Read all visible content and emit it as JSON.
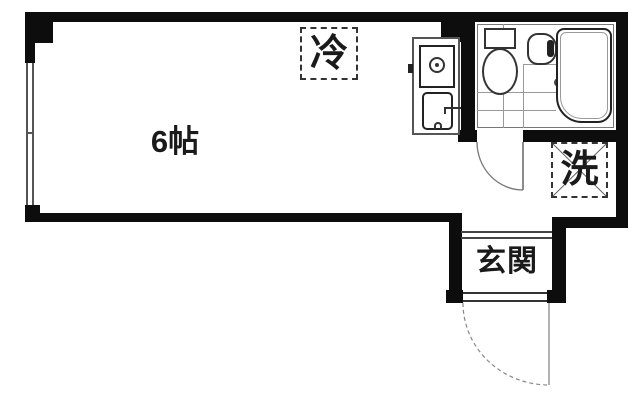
{
  "plan": {
    "title": "apartment-floor-plan",
    "room": {
      "label": "6帖"
    },
    "fridge_space": {
      "label": "冷"
    },
    "washer_space": {
      "label": "洗"
    },
    "entrance": {
      "label": "玄関"
    }
  },
  "fixtures": [
    "window",
    "kitchen-unit",
    "gas-stove-burner",
    "kitchen-sink",
    "unit-bathroom",
    "toilet",
    "wash-basin",
    "bathtub",
    "floor-drain",
    "bathroom-door",
    "entrance-door",
    "entrance-step",
    "entrance-threshold"
  ],
  "colors": {
    "wall": "#0d0d0d",
    "fixture_line": "#333333",
    "tile_line": "#9a9a9a",
    "door_line": "#777777",
    "text": "#1a1a1a",
    "background": "#ffffff"
  }
}
